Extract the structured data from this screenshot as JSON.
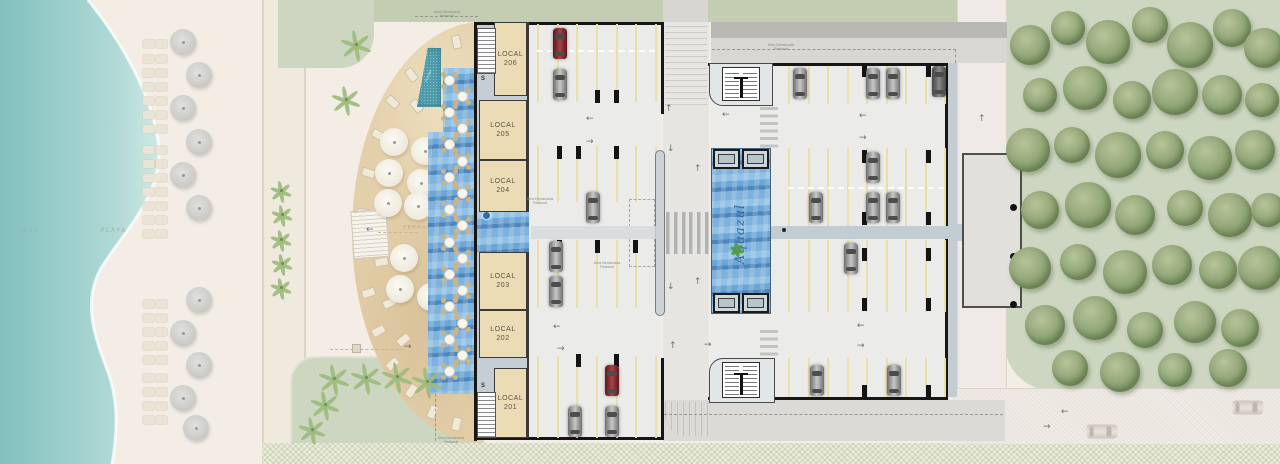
{
  "brand": {
    "name": "Aquazul",
    "text_color": "#38679f",
    "palm_color": "#4f9a45"
  },
  "labels": {
    "sea": "MAR",
    "beach": "PLAYA",
    "terrace": "TERRAZA",
    "pool": "PISCINA",
    "stairs": "S"
  },
  "locals": [
    {
      "name": "LOCAL",
      "number": "206"
    },
    {
      "name": "LOCAL",
      "number": "205"
    },
    {
      "name": "LOCAL",
      "number": "204"
    },
    {
      "name": "LOCAL",
      "number": "203"
    },
    {
      "name": "LOCAL",
      "number": "202"
    },
    {
      "name": "LOCAL",
      "number": "201"
    }
  ],
  "annotation": {
    "line1": "Área Demarcada",
    "line2": "Peatonal"
  },
  "colors": {
    "sea": "#9fd0cd",
    "sand": "#f3ede5",
    "lawn": "#cdd6c1",
    "deck": "#e3cfa9",
    "pool": "#4f9dab",
    "terrace_blue": "#6ba6d6",
    "garage_floor": "#ebebe9",
    "wall": "#161616",
    "stall_line": "#eadfa9",
    "corridor": "#c2ccd3",
    "road": "#efeae5",
    "car_gray": "#9a9a9a",
    "car_red": "#7d272b"
  }
}
